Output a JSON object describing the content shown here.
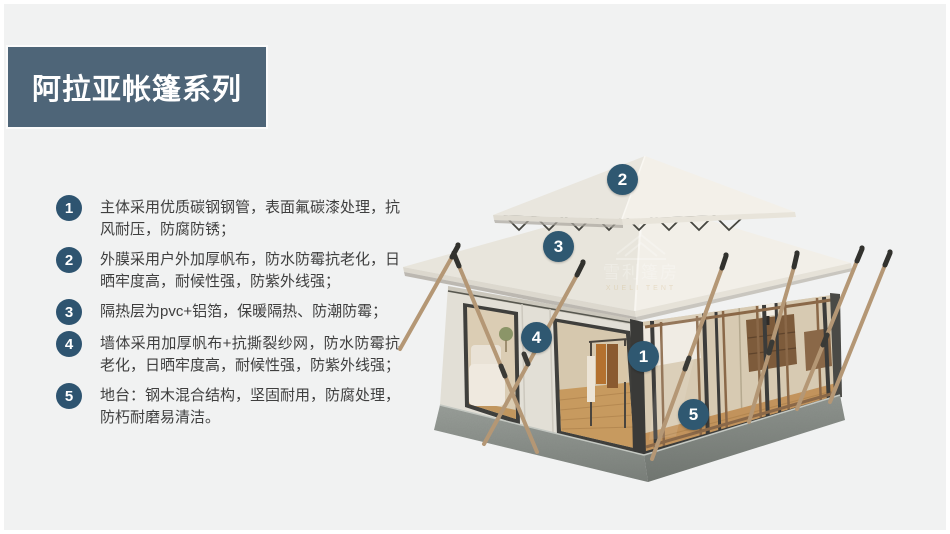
{
  "banner": {
    "title": "阿拉亚帐篷系列",
    "color": "#4e6578"
  },
  "features": [
    {
      "num": "1",
      "text": "主体采用优质碳钢钢管，表面氟碳漆处理，抗风耐压，防腐防锈；"
    },
    {
      "num": "2",
      "text": "外膜采用户外加厚帆布，防水防霉抗老化，日晒牢度高，耐候性强，防紫外线强；"
    },
    {
      "num": "3",
      "text": "隔热层为pvc+铝箔，保暖隔热、防潮防霉；"
    },
    {
      "num": "4",
      "text": "墙体采用加厚帆布+抗撕裂纱网，防水防霉抗老化，日晒牢度高，耐候性强，防紫外线强；"
    },
    {
      "num": "5",
      "text": "地台：钢木混合结构，坚固耐用，防腐处理，防朽耐磨易清洁。"
    }
  ],
  "tent_badges": [
    {
      "num": "2"
    },
    {
      "num": "3"
    },
    {
      "num": "4"
    },
    {
      "num": "1"
    },
    {
      "num": "5"
    }
  ],
  "watermark": {
    "cn": "雪利篷房",
    "en": "XUELI TENT"
  },
  "colors": {
    "accent": "#2e5470",
    "background": "#f1f2f2",
    "roof": "#eeebe3",
    "platform": "#868c86"
  }
}
